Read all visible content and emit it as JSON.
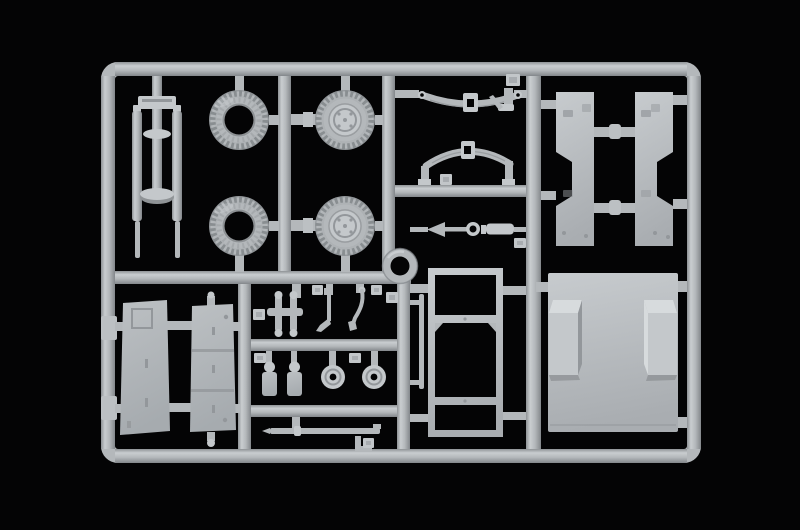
{
  "scene": {
    "type": "photograph",
    "subject": "Unpainted light-grey injection-moulded model kit sprue (parts tree) with military vehicle parts, lying on a black background",
    "background": "black",
    "visible_text": ""
  },
  "colors": {
    "background": "#040405",
    "plastic_base": "#b4b8bb",
    "plastic_light": "#c9cdd0",
    "plastic_dark": "#8f9396",
    "plastic_deep": "#83878b",
    "highlight": "#d7dbdd",
    "tire_mid": "#adb1b4",
    "tire_edge": "#8a8e92",
    "tread": "#898e91",
    "hub_light": "#c4c8cb",
    "panel_light": "#c7cbce",
    "panel_dark": "#a9adb1",
    "door_light": "#bcc0c3",
    "door_dark": "#a6abaf",
    "detail_dark": "#93979b",
    "tag_face": "#c2c6c9"
  },
  "parts": [
    {
      "name": "support-frame",
      "qty": 1,
      "location": "top-left"
    },
    {
      "name": "road-tire",
      "qty": 2,
      "location": "top-left column"
    },
    {
      "name": "wheel-with-hub",
      "qty": 2,
      "location": "top-left column"
    },
    {
      "name": "leaf-spring",
      "qty": 2,
      "location": "top-middle"
    },
    {
      "name": "tie-rod",
      "qty": 1,
      "location": "middle"
    },
    {
      "name": "cargo-side-panel",
      "qty": 2,
      "location": "top-right"
    },
    {
      "name": "door-panel",
      "qty": 1,
      "location": "bottom-left"
    },
    {
      "name": "tailgate-panel",
      "qty": 1,
      "location": "bottom-left"
    },
    {
      "name": "axle-unit",
      "qty": 1,
      "location": "bottom-middle"
    },
    {
      "name": "gear-lever",
      "qty": 1,
      "location": "bottom-middle"
    },
    {
      "name": "brake-lever",
      "qty": 1,
      "location": "bottom-middle"
    },
    {
      "name": "pedal",
      "qty": 2,
      "location": "bottom-middle"
    },
    {
      "name": "hub-disc",
      "qty": 2,
      "location": "bottom-middle"
    },
    {
      "name": "steering-ring",
      "qty": 1,
      "location": "centre"
    },
    {
      "name": "windscreen-frame",
      "qty": 1,
      "location": "bottom-centre"
    },
    {
      "name": "floor-panel-with-wheel-arches",
      "qty": 1,
      "location": "bottom-right"
    },
    {
      "name": "long-rod",
      "qty": 1,
      "location": "bottom"
    },
    {
      "name": "thin-rod",
      "qty": 1,
      "location": "centre"
    },
    {
      "name": "small-bracket",
      "qty": 2,
      "location": "various"
    },
    {
      "name": "moulded-number-tag",
      "qty": 10,
      "location": "on runners"
    }
  ]
}
